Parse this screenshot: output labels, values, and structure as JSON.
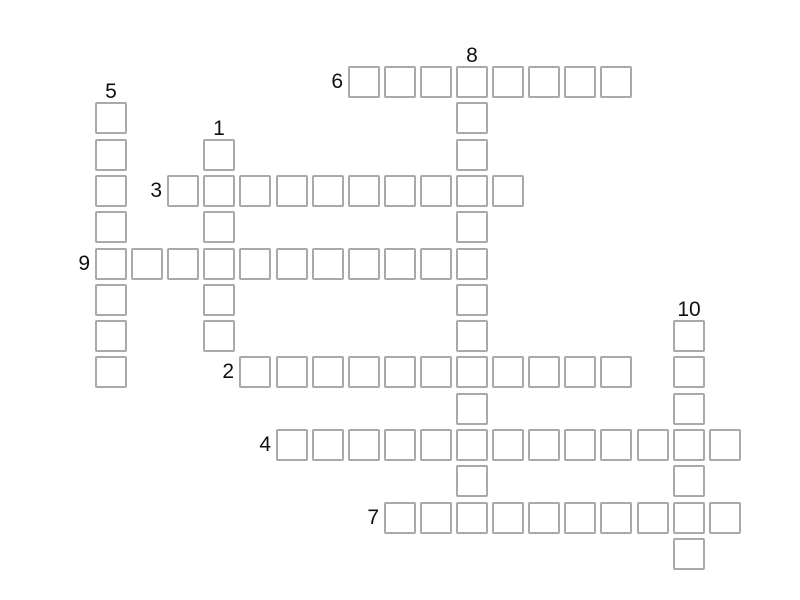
{
  "canvas": {
    "width": 800,
    "height": 600,
    "background": "#ffffff"
  },
  "grid": {
    "origin_x": 95,
    "origin_y": 66,
    "pitch_x": 36.1,
    "pitch_y": 36.3,
    "cell_size": 32,
    "cell_fill": "#ffffff",
    "cell_border_color": "#a9a9a9",
    "cell_border_width": 2,
    "number_color": "#111111",
    "number_font_size": 21,
    "across_label_gap": 5,
    "down_label_gap": 4
  },
  "words": [
    {
      "number": "1",
      "direction": "down",
      "col": 3,
      "row": 2,
      "length": 6,
      "entry": ""
    },
    {
      "number": "2",
      "direction": "across",
      "col": 4,
      "row": 8,
      "length": 11,
      "entry": ""
    },
    {
      "number": "3",
      "direction": "across",
      "col": 2,
      "row": 3,
      "length": 10,
      "entry": ""
    },
    {
      "number": "4",
      "direction": "across",
      "col": 5,
      "row": 10,
      "length": 13,
      "entry": ""
    },
    {
      "number": "5",
      "direction": "down",
      "col": 0,
      "row": 1,
      "length": 8,
      "entry": ""
    },
    {
      "number": "6",
      "direction": "across",
      "col": 7,
      "row": 0,
      "length": 8,
      "entry": ""
    },
    {
      "number": "7",
      "direction": "across",
      "col": 8,
      "row": 12,
      "length": 10,
      "entry": ""
    },
    {
      "number": "8",
      "direction": "down",
      "col": 10,
      "row": 0,
      "length": 13,
      "entry": ""
    },
    {
      "number": "9",
      "direction": "across",
      "col": 0,
      "row": 5,
      "length": 11,
      "entry": ""
    },
    {
      "number": "10",
      "direction": "down",
      "col": 16,
      "row": 7,
      "length": 7,
      "entry": ""
    }
  ]
}
